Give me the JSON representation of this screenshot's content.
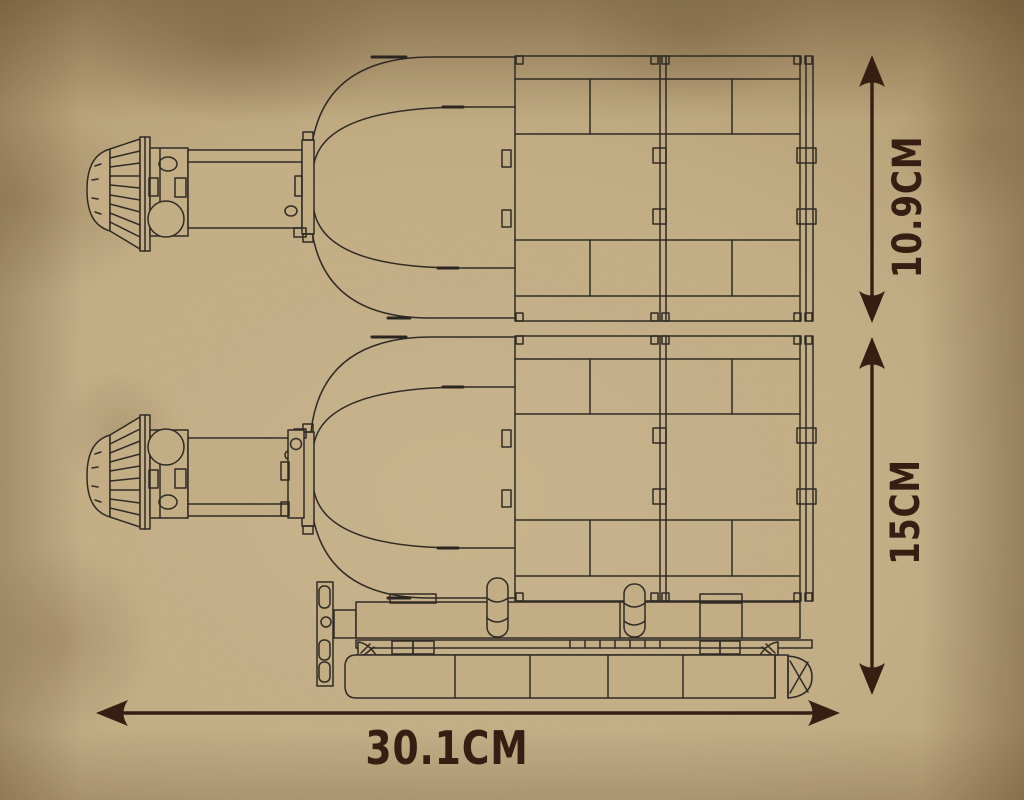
{
  "dimensions": {
    "upper_height_label": "10.9CM",
    "total_height_label": "15CM",
    "length_label": "30.1CM"
  },
  "colors": {
    "paper": "#d5c29a",
    "line": "#35302a",
    "dimension": "#3b2114"
  }
}
